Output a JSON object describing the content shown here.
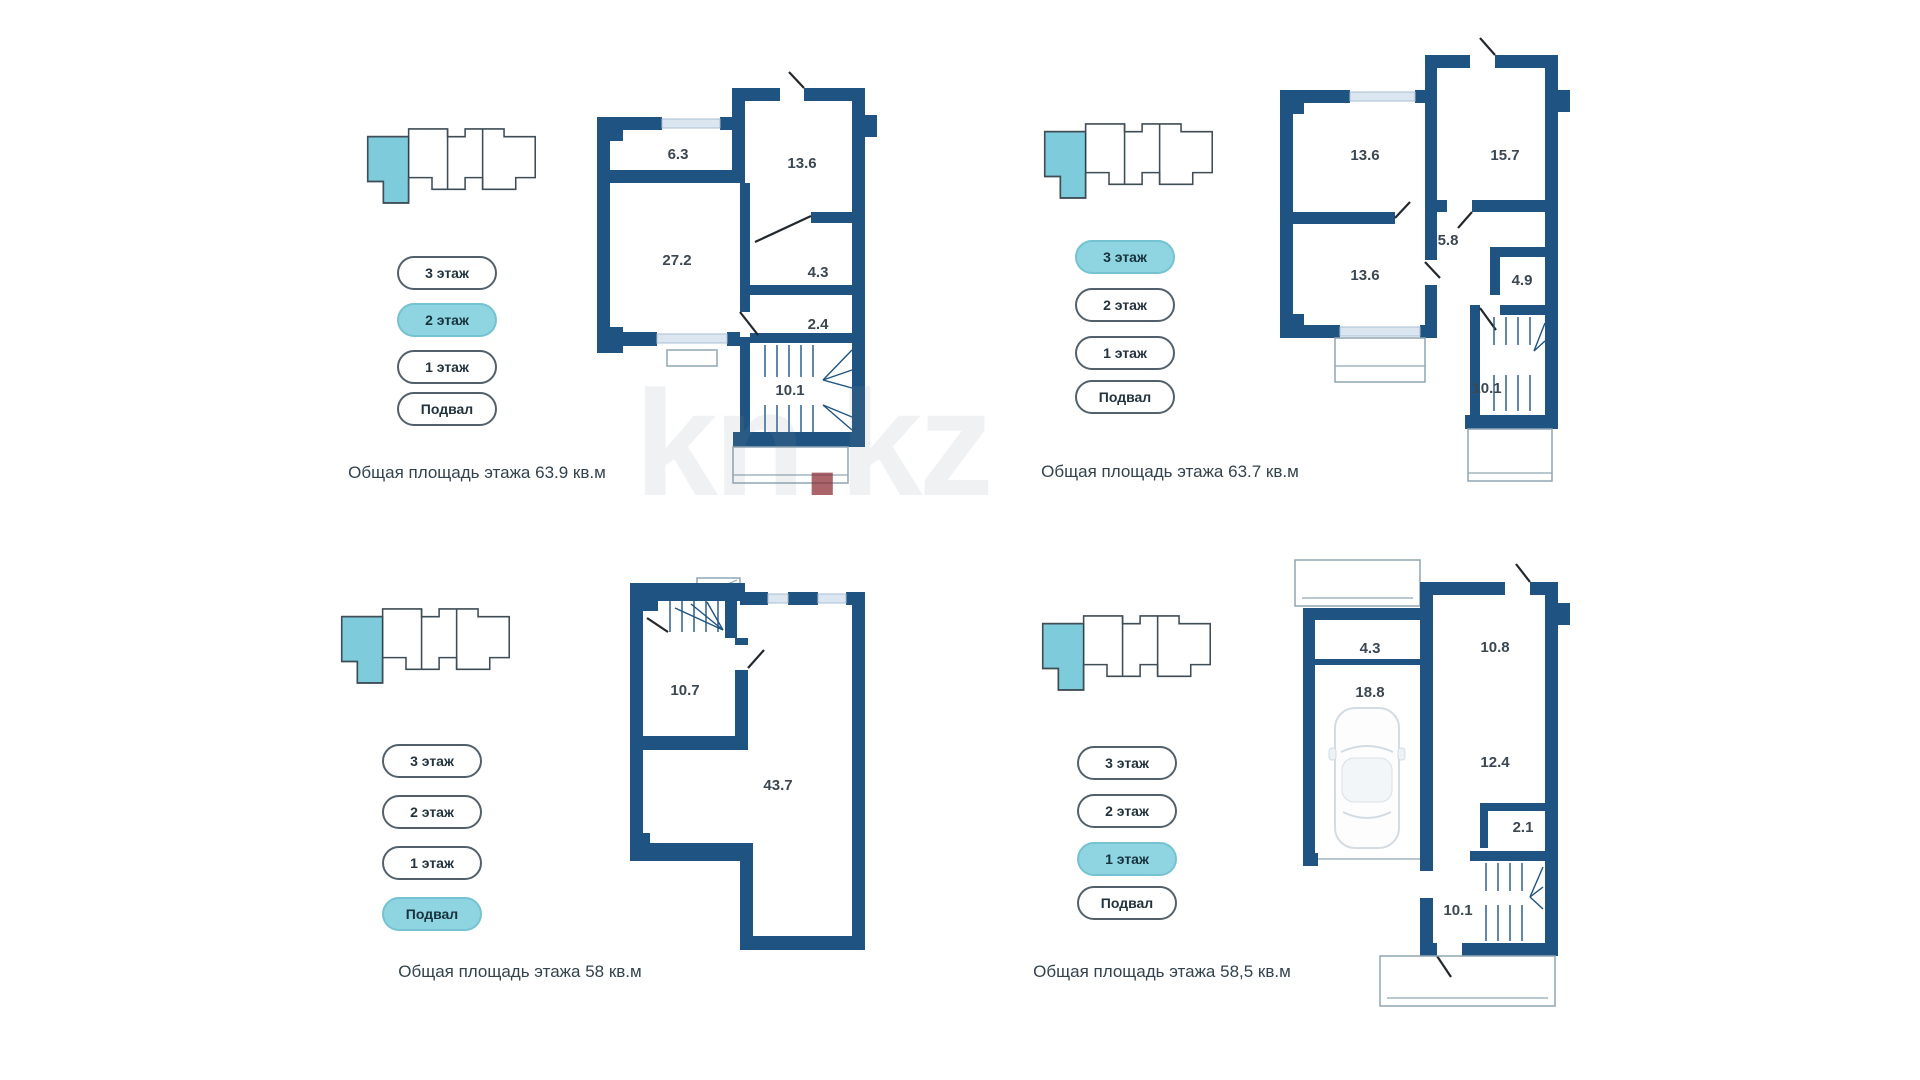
{
  "watermark": {
    "pre": "kn",
    "dot": ".",
    "post": "kz"
  },
  "colors": {
    "wall": "#1e5382",
    "accent": "#8ed4e1",
    "pill_outline": "#51606b"
  },
  "panels": [
    {
      "name": "2 этаж",
      "floor_buttons": [
        {
          "label": "3 этаж",
          "active": false
        },
        {
          "label": "2 этаж",
          "active": true
        },
        {
          "label": "1 этаж",
          "active": false
        },
        {
          "label": "Подвал",
          "active": false
        }
      ],
      "rooms": [
        "6.3",
        "13.6",
        "27.2",
        "4.3",
        "2.4",
        "10.1"
      ],
      "caption": "Общая площадь этажа 63.9 кв.м"
    },
    {
      "name": "3 этаж",
      "floor_buttons": [
        {
          "label": "3 этаж",
          "active": true
        },
        {
          "label": "2 этаж",
          "active": false
        },
        {
          "label": "1 этаж",
          "active": false
        },
        {
          "label": "Подвал",
          "active": false
        }
      ],
      "rooms": [
        "13.6",
        "15.7",
        "5.8",
        "13.6",
        "4.9",
        "10.1"
      ],
      "caption": "Общая площадь этажа 63.7 кв.м"
    },
    {
      "name": "Подвал",
      "floor_buttons": [
        {
          "label": "3 этаж",
          "active": false
        },
        {
          "label": "2 этаж",
          "active": false
        },
        {
          "label": "1 этаж",
          "active": false
        },
        {
          "label": "Подвал",
          "active": true
        }
      ],
      "rooms": [
        "10.7",
        "43.7"
      ],
      "caption": "Общая площадь этажа 58 кв.м"
    },
    {
      "name": "1 этаж",
      "floor_buttons": [
        {
          "label": "3 этаж",
          "active": false
        },
        {
          "label": "2 этаж",
          "active": false
        },
        {
          "label": "1 этаж",
          "active": true
        },
        {
          "label": "Подвал",
          "active": false
        }
      ],
      "rooms": [
        "4.3",
        "10.8",
        "18.8",
        "12.4",
        "2.1",
        "10.1"
      ],
      "caption": "Общая площадь этажа 58,5 кв.м"
    }
  ]
}
